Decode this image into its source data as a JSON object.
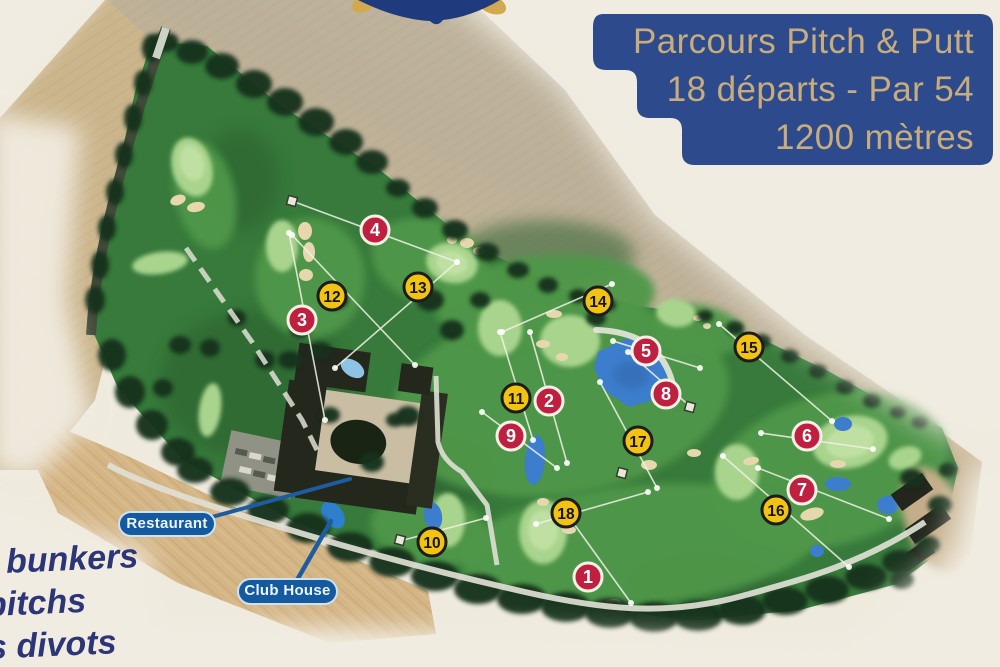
{
  "title_box": {
    "lines": [
      "Parcours Pitch & Putt",
      "18 départs - Par 54",
      "1200 mètres"
    ],
    "bg": "#2c4a8c",
    "text_color": "#c8ac7b"
  },
  "course_labels": {
    "restaurant": "Restaurant",
    "club_house": "Club House",
    "pill_bg": "#15599e",
    "pill_text": "#eaf5fd"
  },
  "legend_fragments": [
    "bunkers",
    "pitchs",
    "s divots"
  ],
  "legend_color": "#2c3677",
  "marker_styles": {
    "red": {
      "fill": "#c02040",
      "ring": "#f6f1e6",
      "text": "#ffffff"
    },
    "yellow": {
      "fill": "#f2c411",
      "ring": "#1c1c1c",
      "text": "#141414"
    }
  },
  "markers": [
    {
      "n": "1",
      "color": "red",
      "x": 588,
      "y": 577
    },
    {
      "n": "2",
      "color": "red",
      "x": 549,
      "y": 401
    },
    {
      "n": "3",
      "color": "red",
      "x": 302,
      "y": 320
    },
    {
      "n": "4",
      "color": "red",
      "x": 375,
      "y": 230
    },
    {
      "n": "5",
      "color": "red",
      "x": 646,
      "y": 351
    },
    {
      "n": "6",
      "color": "red",
      "x": 807,
      "y": 436
    },
    {
      "n": "7",
      "color": "red",
      "x": 802,
      "y": 490
    },
    {
      "n": "8",
      "color": "red",
      "x": 666,
      "y": 394
    },
    {
      "n": "9",
      "color": "red",
      "x": 511,
      "y": 436
    },
    {
      "n": "10",
      "color": "yellow",
      "x": 432,
      "y": 542
    },
    {
      "n": "11",
      "color": "yellow",
      "x": 516,
      "y": 398
    },
    {
      "n": "12",
      "color": "yellow",
      "x": 332,
      "y": 296
    },
    {
      "n": "13",
      "color": "yellow",
      "x": 418,
      "y": 287
    },
    {
      "n": "14",
      "color": "yellow",
      "x": 598,
      "y": 301
    },
    {
      "n": "15",
      "color": "yellow",
      "x": 749,
      "y": 347
    },
    {
      "n": "16",
      "color": "yellow",
      "x": 776,
      "y": 510
    },
    {
      "n": "17",
      "color": "yellow",
      "x": 638,
      "y": 441
    },
    {
      "n": "18",
      "color": "yellow",
      "x": 566,
      "y": 513
    }
  ],
  "hole_lines": [
    [
      292,
      201,
      457,
      262
    ],
    [
      289,
      233,
      325,
      420
    ],
    [
      457,
      262,
      335,
      368
    ],
    [
      292,
      235,
      415,
      365
    ],
    [
      502,
      332,
      612,
      284
    ],
    [
      613,
      341,
      700,
      368
    ],
    [
      628,
      352,
      692,
      408
    ],
    [
      530,
      332,
      567,
      463
    ],
    [
      500,
      332,
      533,
      440
    ],
    [
      482,
      412,
      557,
      468
    ],
    [
      600,
      382,
      657,
      488
    ],
    [
      761,
      433,
      873,
      449
    ],
    [
      719,
      324,
      832,
      421
    ],
    [
      758,
      468,
      889,
      519
    ],
    [
      723,
      456,
      849,
      567
    ],
    [
      536,
      524,
      648,
      492
    ],
    [
      569,
      517,
      631,
      603
    ],
    [
      400,
      541,
      486,
      518
    ]
  ],
  "tee_squares": [
    [
      292,
      201
    ],
    [
      690,
      407
    ],
    [
      400,
      540
    ],
    [
      622,
      473
    ]
  ]
}
